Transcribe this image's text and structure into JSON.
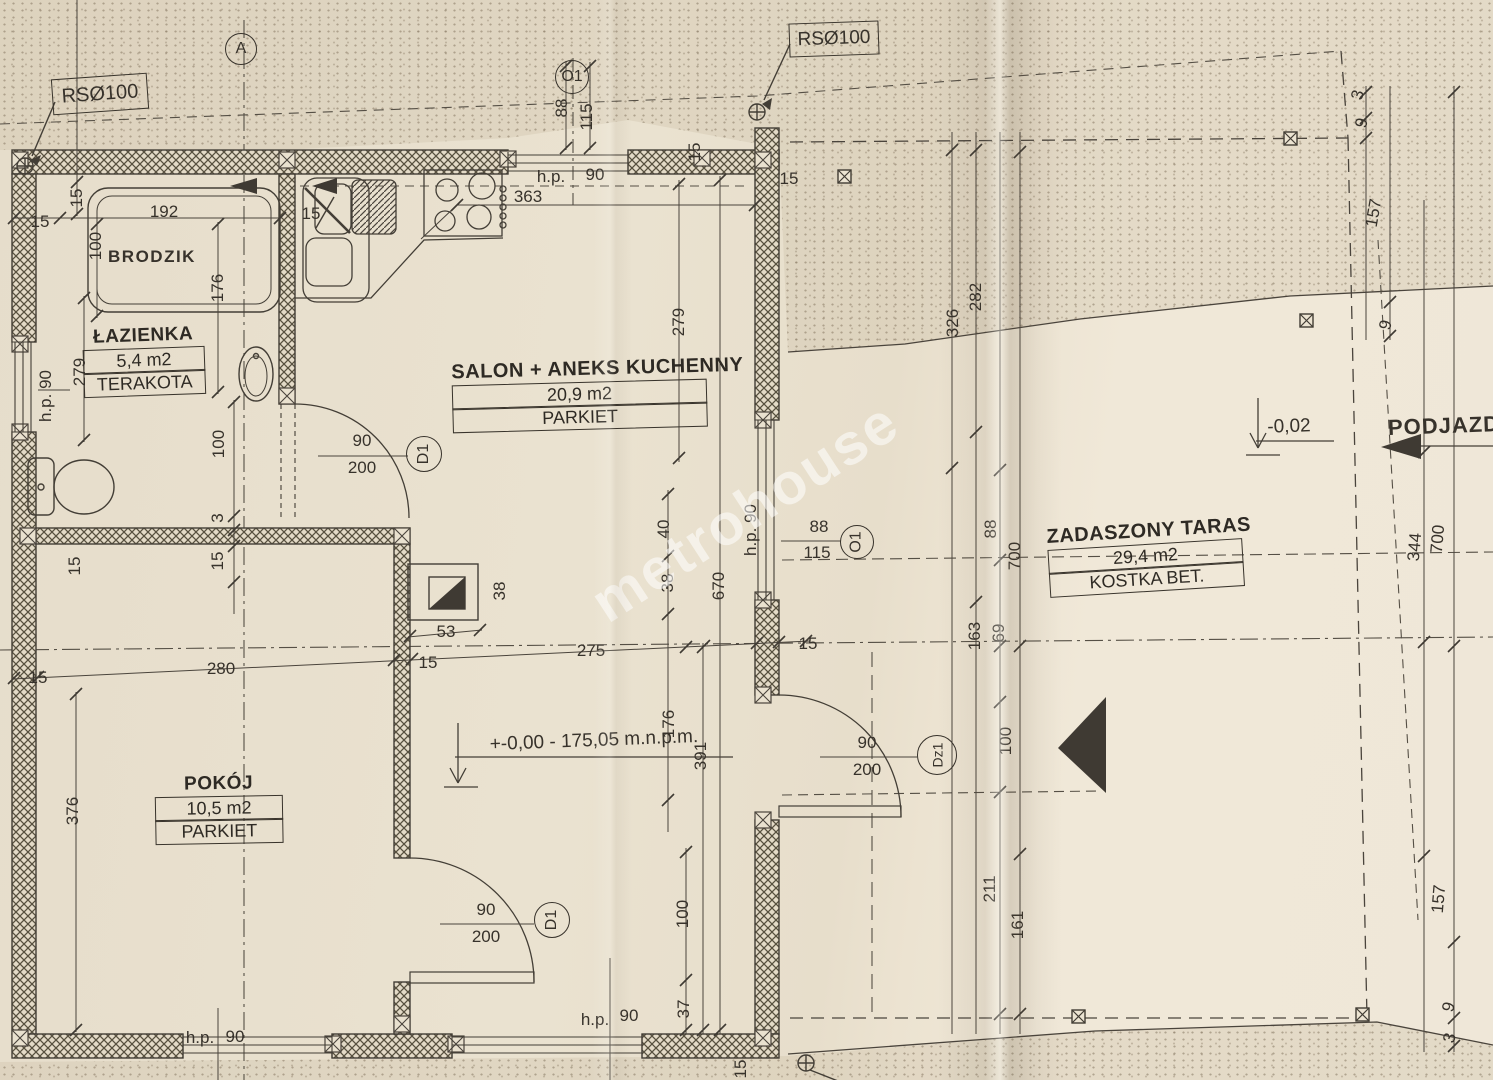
{
  "watermark": "metrohouse",
  "annotations": {
    "rs_top_left": "RSØ100",
    "rs_top_right": "RSØ100",
    "brodzik": "BRODZIK",
    "elevation_main": "+-0,00 - 175,05 m.n.p.m.",
    "elevation_terrace": "-0,02",
    "podjazd": "PODJAZD"
  },
  "rooms": {
    "lazienka": {
      "name": "ŁAZIENKA",
      "area": "5,4 m2",
      "floor": "TERAKOTA"
    },
    "salon": {
      "name": "SALON + ANEKS KUCHENNY",
      "area": "20,9 m2",
      "floor": "PARKIET"
    },
    "pokoj": {
      "name": "POKÓJ",
      "area": "10,5 m2",
      "floor": "PARKIET"
    },
    "taras": {
      "name": "ZADASZONY TARAS",
      "area": "29,4 m2",
      "floor": "KOSTKA BET."
    }
  },
  "markers": [
    {
      "label": "A",
      "x": 240,
      "y": 48,
      "d": 30,
      "r": 0
    },
    {
      "label": "O1",
      "x": 571,
      "y": 76,
      "d": 32,
      "r": 0
    },
    {
      "label": "O1",
      "x": 856,
      "y": 541,
      "d": 32,
      "r": -90
    },
    {
      "label": "D1",
      "x": 423,
      "y": 453,
      "d": 34,
      "r": -90
    },
    {
      "label": "D1",
      "x": 551,
      "y": 919,
      "d": 34,
      "r": -90
    },
    {
      "label": "Dz1",
      "x": 936,
      "y": 754,
      "d": 38,
      "r": -90
    }
  ],
  "door_sizes": [
    {
      "width": "90",
      "height": "200",
      "x": 362,
      "y": 455
    },
    {
      "width": "90",
      "height": "200",
      "x": 486,
      "y": 924
    },
    {
      "width": "90",
      "height": "200",
      "x": 867,
      "y": 757
    }
  ],
  "dimensions": [
    {
      "t": "15",
      "x": 40,
      "y": 222,
      "r": 0
    },
    {
      "t": "15",
      "x": 77,
      "y": 198,
      "r": -90
    },
    {
      "t": "192",
      "x": 164,
      "y": 212,
      "r": 0
    },
    {
      "t": "100",
      "x": 96,
      "y": 246,
      "r": -90
    },
    {
      "t": "176",
      "x": 218,
      "y": 288,
      "r": -90
    },
    {
      "t": "15",
      "x": 311,
      "y": 214,
      "r": 0
    },
    {
      "t": "279",
      "x": 80,
      "y": 372,
      "r": -90
    },
    {
      "t": "h.p. 90",
      "x": 46,
      "y": 396,
      "r": -90
    },
    {
      "t": "88",
      "x": 562,
      "y": 108,
      "r": -90
    },
    {
      "t": "115",
      "x": 587,
      "y": 117,
      "r": -90
    },
    {
      "t": "h.p.",
      "x": 551,
      "y": 177,
      "r": 0
    },
    {
      "t": "90",
      "x": 595,
      "y": 175,
      "r": 0
    },
    {
      "t": "363",
      "x": 528,
      "y": 197,
      "r": 0
    },
    {
      "t": "15",
      "x": 695,
      "y": 152,
      "r": -90
    },
    {
      "t": "15",
      "x": 789,
      "y": 179,
      "r": 0
    },
    {
      "t": "282",
      "x": 976,
      "y": 297,
      "r": -90
    },
    {
      "t": "326",
      "x": 953,
      "y": 323,
      "r": -90
    },
    {
      "t": "279",
      "x": 679,
      "y": 322,
      "r": -90
    },
    {
      "t": "3",
      "x": 1358,
      "y": 95,
      "r": -75
    },
    {
      "t": "9",
      "x": 1362,
      "y": 123,
      "r": -75
    },
    {
      "t": "157",
      "x": 1374,
      "y": 213,
      "r": -80
    },
    {
      "t": "9",
      "x": 1386,
      "y": 325,
      "r": -75
    },
    {
      "t": "40",
      "x": 664,
      "y": 529,
      "r": -90
    },
    {
      "t": "38",
      "x": 668,
      "y": 583,
      "r": -90
    },
    {
      "t": "670",
      "x": 719,
      "y": 586,
      "r": -90
    },
    {
      "t": "88",
      "x": 819,
      "y": 527,
      "r": 0
    },
    {
      "t": "115",
      "x": 817,
      "y": 553,
      "r": 0
    },
    {
      "t": "h.p. 90",
      "x": 751,
      "y": 530,
      "r": -90
    },
    {
      "t": "15",
      "x": 808,
      "y": 644,
      "r": 0
    },
    {
      "t": "163",
      "x": 975,
      "y": 636,
      "r": -90
    },
    {
      "t": "69",
      "x": 999,
      "y": 633,
      "r": -90
    },
    {
      "t": "88",
      "x": 991,
      "y": 529,
      "r": -90
    },
    {
      "t": "700",
      "x": 1015,
      "y": 556,
      "r": -90
    },
    {
      "t": "100",
      "x": 1006,
      "y": 741,
      "r": -90
    },
    {
      "t": "211",
      "x": 990,
      "y": 889,
      "r": -90
    },
    {
      "t": "161",
      "x": 1018,
      "y": 925,
      "r": -90
    },
    {
      "t": "100",
      "x": 219,
      "y": 444,
      "r": -90
    },
    {
      "t": "3",
      "x": 218,
      "y": 518,
      "r": -90
    },
    {
      "t": "15",
      "x": 75,
      "y": 566,
      "r": -90
    },
    {
      "t": "15",
      "x": 218,
      "y": 561,
      "r": -90
    },
    {
      "t": "280",
      "x": 221,
      "y": 669,
      "r": 0
    },
    {
      "t": "15",
      "x": 38,
      "y": 678,
      "r": 0
    },
    {
      "t": "53",
      "x": 446,
      "y": 632,
      "r": 0
    },
    {
      "t": "15",
      "x": 428,
      "y": 663,
      "r": 0
    },
    {
      "t": "38",
      "x": 500,
      "y": 591,
      "r": -90
    },
    {
      "t": "275",
      "x": 591,
      "y": 651,
      "r": 0
    },
    {
      "t": "176",
      "x": 669,
      "y": 724,
      "r": -90
    },
    {
      "t": "391",
      "x": 701,
      "y": 756,
      "r": -90
    },
    {
      "t": "100",
      "x": 683,
      "y": 914,
      "r": -90
    },
    {
      "t": "37",
      "x": 684,
      "y": 1009,
      "r": -90
    },
    {
      "t": "376",
      "x": 73,
      "y": 811,
      "r": -90
    },
    {
      "t": "h.p.",
      "x": 200,
      "y": 1038,
      "r": 0
    },
    {
      "t": "90",
      "x": 235,
      "y": 1037,
      "r": 0
    },
    {
      "t": "h.p.",
      "x": 595,
      "y": 1020,
      "r": 0
    },
    {
      "t": "90",
      "x": 629,
      "y": 1016,
      "r": 0
    },
    {
      "t": "15",
      "x": 741,
      "y": 1069,
      "r": -90
    },
    {
      "t": "344",
      "x": 1415,
      "y": 547,
      "r": -85
    },
    {
      "t": "700",
      "x": 1438,
      "y": 539,
      "r": -85
    },
    {
      "t": "157",
      "x": 1439,
      "y": 899,
      "r": -85
    },
    {
      "t": "9",
      "x": 1449,
      "y": 1007,
      "r": -75
    },
    {
      "t": "3",
      "x": 1450,
      "y": 1038,
      "r": -75
    }
  ]
}
